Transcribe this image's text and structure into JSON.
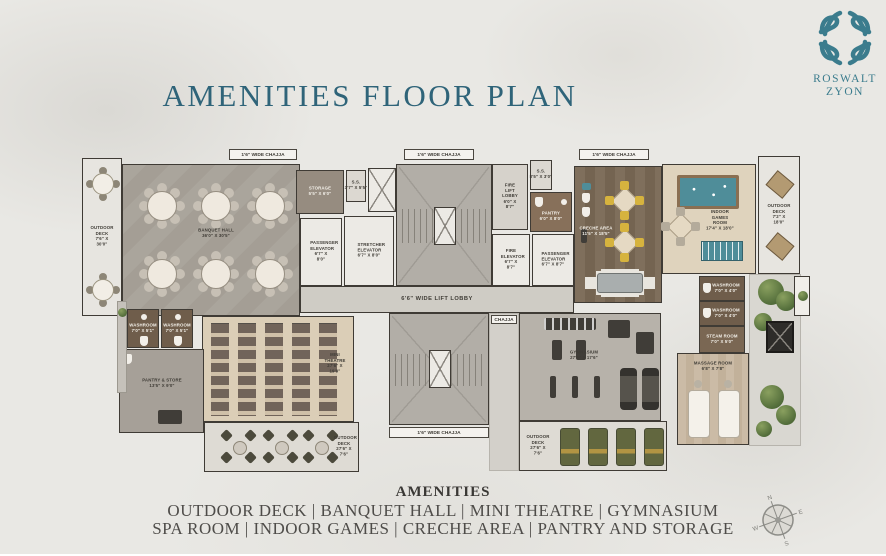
{
  "page": {
    "title": "AMENITIES FLOOR PLAN"
  },
  "logo": {
    "line1": "ROSWALT",
    "line2": "ZYON"
  },
  "footer": {
    "heading": "AMENITIES",
    "line1": "OUTDOOR DECK | BANQUET HALL | MINI THEATRE | GYMNASIUM",
    "line2": "SPA ROOM | INDOOR GAMES | CRECHE AREA | PANTRY AND STORAGE"
  },
  "compass": {
    "n": "N",
    "e": "E",
    "s": "S",
    "w": "W"
  },
  "colors": {
    "title": "#2f6479",
    "logo": "#3b7c8d",
    "footer_text": "#4e4c49"
  },
  "icons": {
    "logo": "ornamental-tile-grid-icon",
    "compass": "compass-rose-icon"
  },
  "plan": {
    "corridors": {
      "lift_lobby": "6'6\" WIDE LIFT LOBBY",
      "chajja_wide": "1'6\" WIDE CHAJJA",
      "chajja": "CHAJJA"
    },
    "rooms": {
      "outdoor_deck_left": {
        "name": "OUTDOOR DECK",
        "dims": "7'6\" X 30'0\""
      },
      "banquet_hall": {
        "name": "BANQUET HALL",
        "dims": "36'0\" X 30'5\""
      },
      "storage": {
        "name": "STORAGE",
        "dims": "5'5\" X 6'0\""
      },
      "ss_left": {
        "name": "S.S.",
        "dims": "3'7\" X 5'5\""
      },
      "passenger_elevator_left": {
        "name": "PASSENGER ELEVATOR",
        "dims": "6'7\" X 8'0\""
      },
      "stretcher_elevator": {
        "name": "STRETCHER ELEVATOR",
        "dims": "6'7\" X 8'0\""
      },
      "fire_lift_lobby": {
        "name": "FIRE LIFT LOBBY",
        "dims": "6'0\" X 8'7\""
      },
      "ss_right": {
        "name": "S.S.",
        "dims": "8'5\" X 3'0\""
      },
      "pantry": {
        "name": "PANTRY",
        "dims": "6'0\" X 8'0\""
      },
      "fire_elevator": {
        "name": "FIRE ELEVATOR",
        "dims": "6'7\" X 8'7\""
      },
      "passenger_elevator_right": {
        "name": "PASSENGER ELEVATOR",
        "dims": "6'7\" X 8'7\""
      },
      "creche_area": {
        "name": "CRECHE AREA",
        "dims": "11'5\" X 18'5\""
      },
      "indoor_games_room": {
        "name": "INDOOR GAMES ROOM",
        "dims": "17'4\" X 18'0\""
      },
      "outdoor_deck_right": {
        "name": "OUTDOOR DECK",
        "dims": "7'2\" X 18'0\""
      },
      "washroom_right_1": {
        "name": "WASHROOM",
        "dims": "7'0\" X 4'0\""
      },
      "washroom_right_2": {
        "name": "WASHROOM",
        "dims": "7'0\" X 4'0\""
      },
      "steam_room": {
        "name": "STEAM ROOM",
        "dims": "7'0\" X 5'0\""
      },
      "massage_room": {
        "name": "MASSAGE ROOM",
        "dims": "6'8\" X 7'8\""
      },
      "gymnasium": {
        "name": "GYMNASIUM",
        "dims": "27'6\" X 17'6\""
      },
      "outdoor_deck_gym": {
        "name": "OUTDOOR DECK",
        "dims": "27'6\" X 7'6\""
      },
      "mini_theatre": {
        "name": "MINI THEATRE",
        "dims": "27'6\" X 19'9\""
      },
      "outdoor_deck_theatre": {
        "name": "OUTDOOR DECK",
        "dims": "27'6\" X 7'6\""
      },
      "pantry_store": {
        "name": "PANTRY & STORE",
        "dims": "13'5\" X 9'0\""
      },
      "washroom_left_1": {
        "name": "WASHROOM",
        "dims": "7'0\" X 5'1\""
      },
      "washroom_left_2": {
        "name": "WASHROOM",
        "dims": "7'0\" X 5'1\""
      }
    }
  }
}
